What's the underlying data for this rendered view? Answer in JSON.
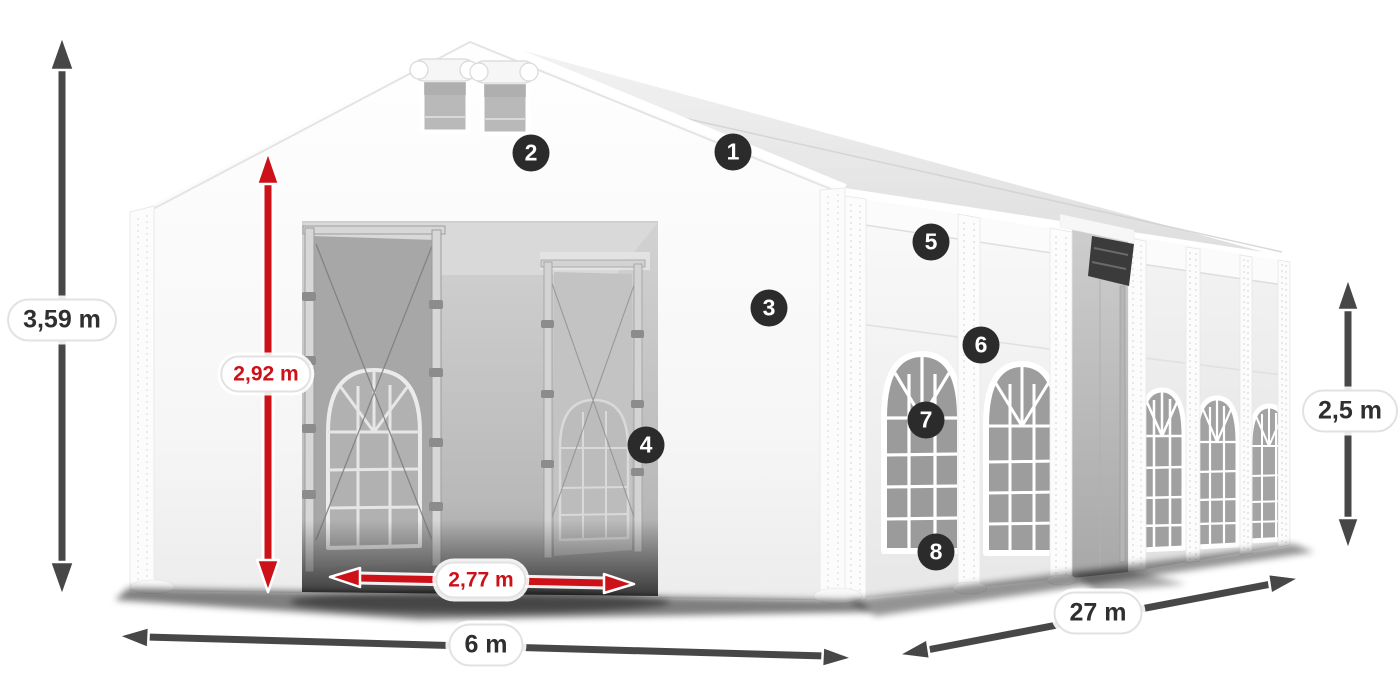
{
  "colors": {
    "background": "#ffffff",
    "tent_white": "#f6f6f6",
    "interior_gray": "#b9b9b9",
    "arrow_dark": "#474747",
    "arrow_red": "#cd1118",
    "pill_background": "#ffffff",
    "pill_border": "#e2e2e2",
    "pill_text_dark": "#2f2f2f",
    "pill_text_red": "#cd1118",
    "badge_background": "#2b2b2b",
    "badge_text": "#ffffff"
  },
  "dimensions": {
    "total_height": {
      "label": "3,59 m",
      "color": "dark"
    },
    "door_height": {
      "label": "2,92 m",
      "color": "red"
    },
    "door_width": {
      "label": "2,77 m",
      "color": "red"
    },
    "front_width": {
      "label": "6 m",
      "color": "dark"
    },
    "length": {
      "label": "27 m",
      "color": "dark"
    },
    "side_height": {
      "label": "2,5 m",
      "color": "dark"
    }
  },
  "markers": [
    "1",
    "2",
    "3",
    "4",
    "5",
    "6",
    "7",
    "8"
  ]
}
